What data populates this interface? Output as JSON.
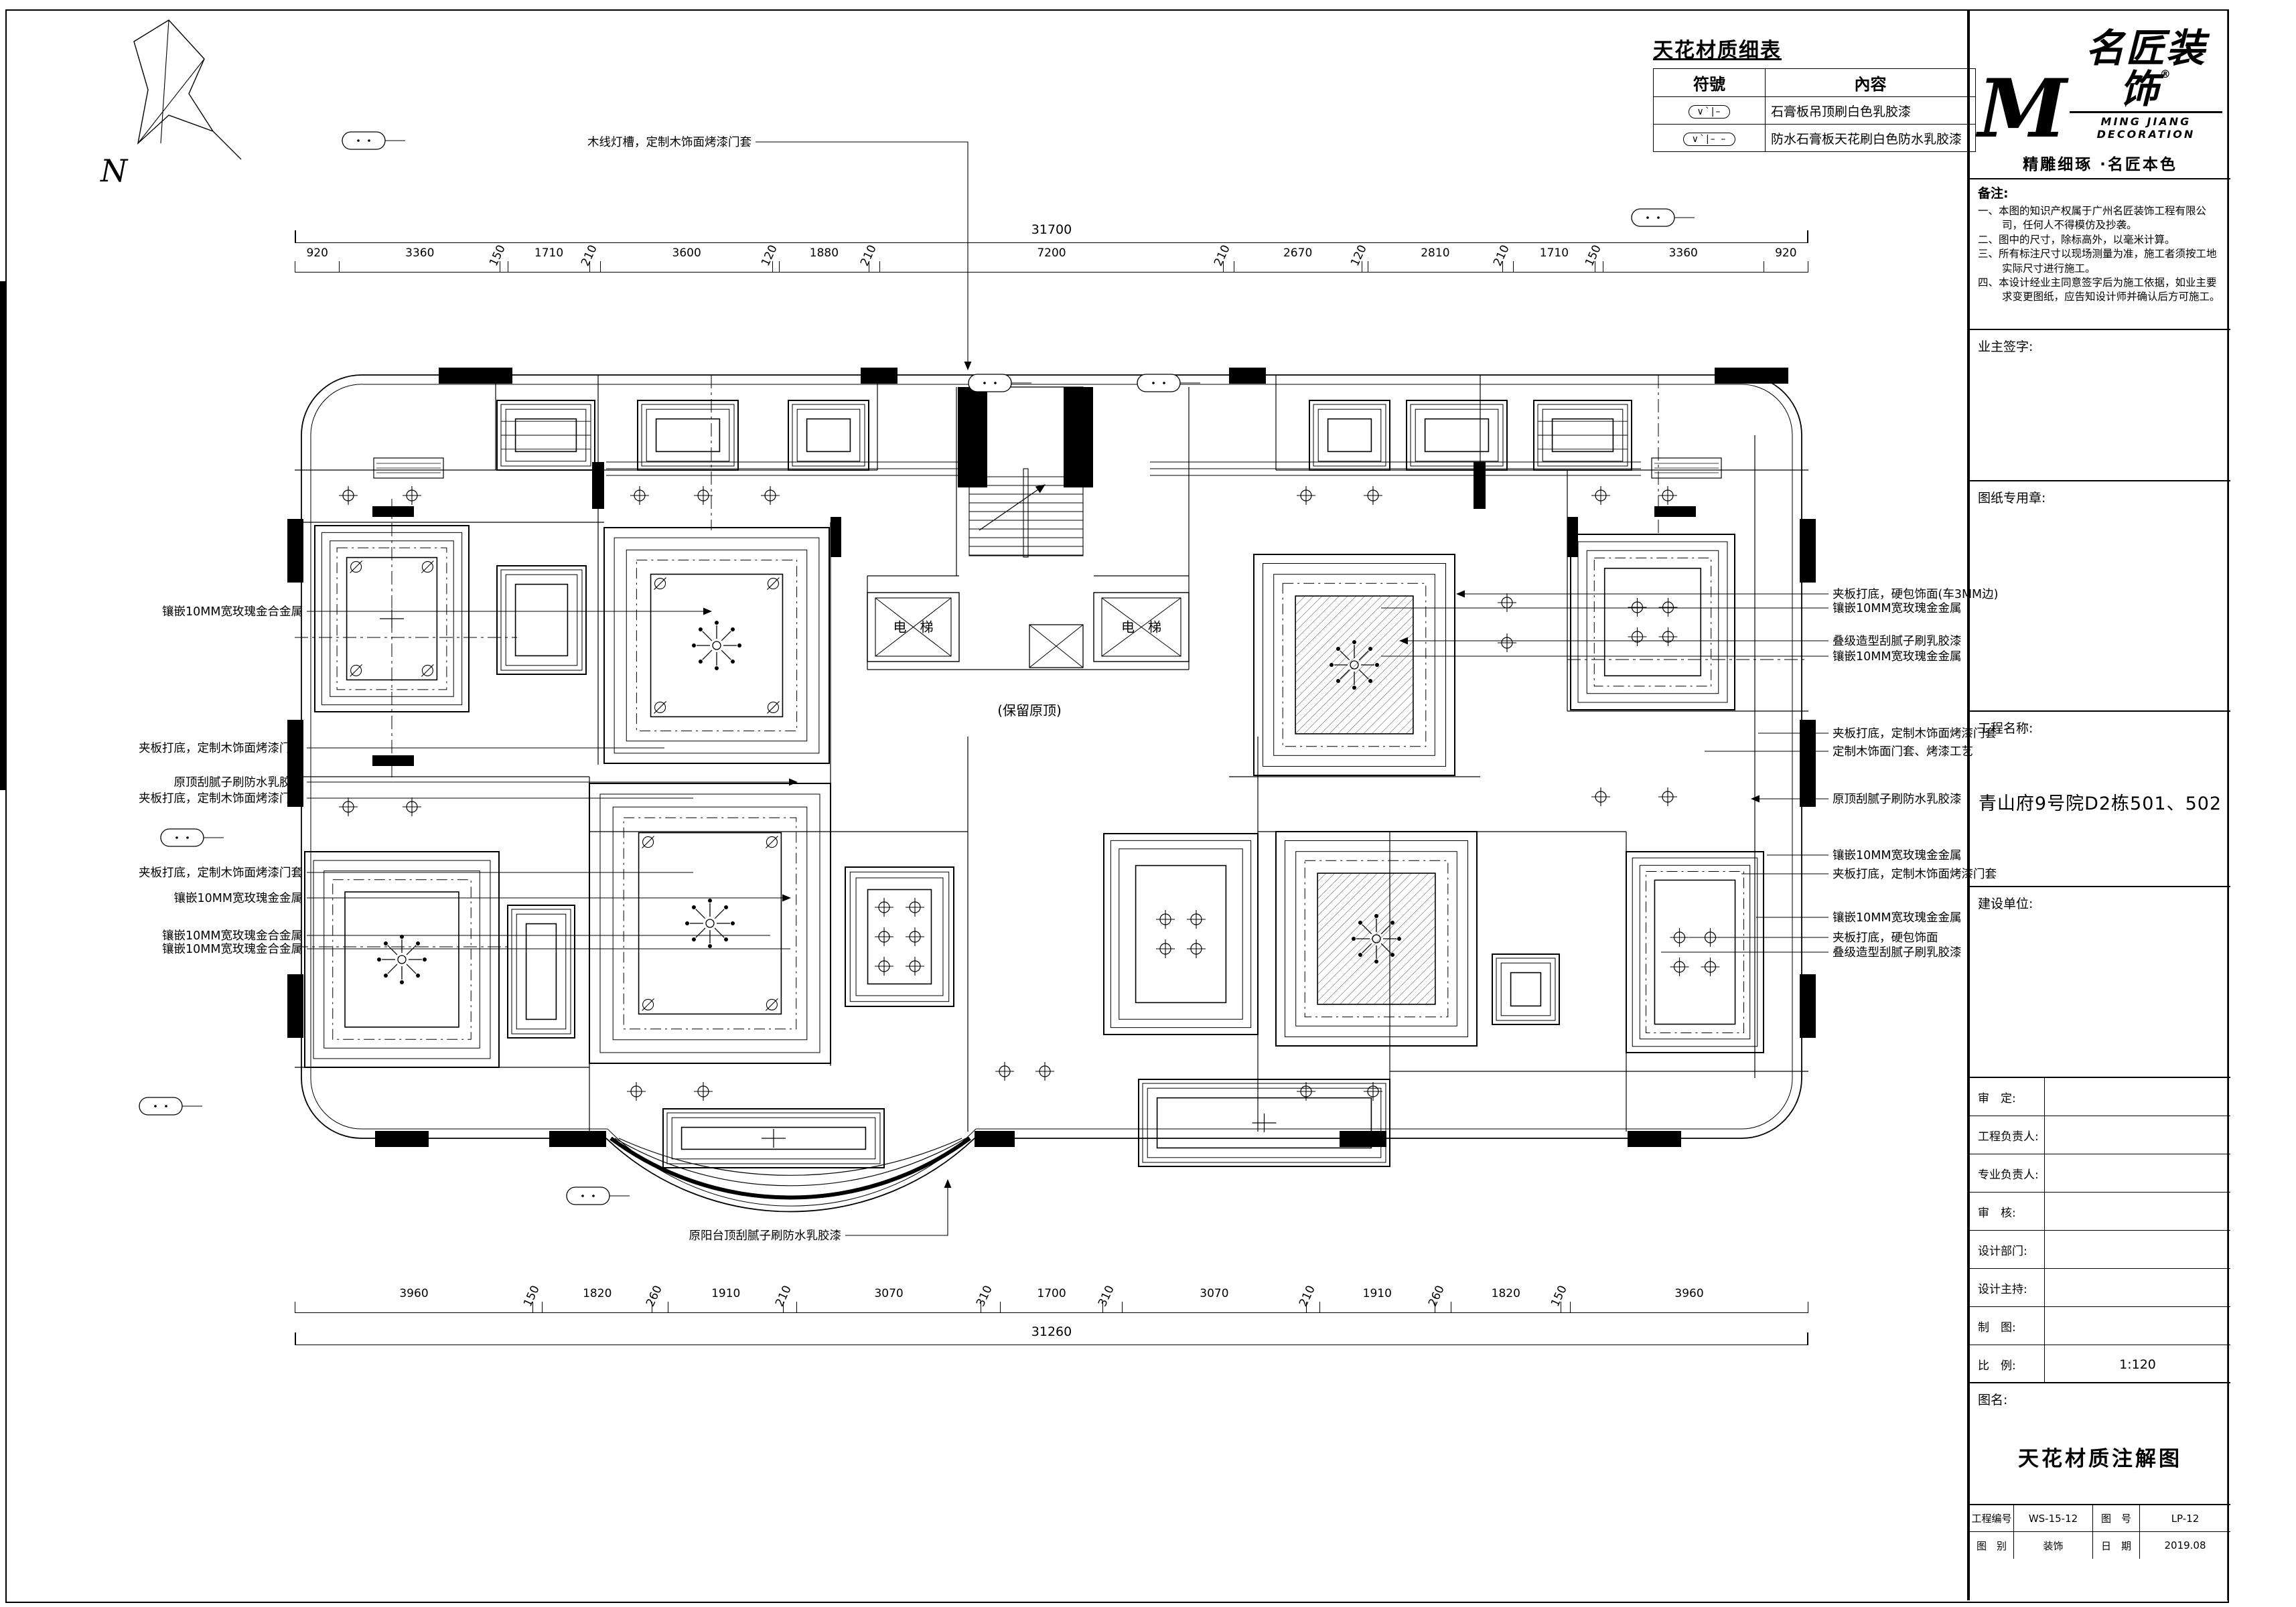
{
  "legend": {
    "title": "天花材质细表",
    "col_symbol": "符號",
    "col_content": "內容",
    "rows": [
      {
        "symbol": "∨ˋ|–",
        "content": "石膏板吊顶刷白色乳胶漆"
      },
      {
        "symbol": "∨ˋ|– –",
        "content": "防水石膏板天花刷白色防水乳胶漆"
      }
    ]
  },
  "plan": {
    "north": "N",
    "elevator": "电　梯",
    "keep_ceiling": "(保留原顶)"
  },
  "dimensions": {
    "top": {
      "total": "31700",
      "values": [
        920,
        3360,
        150,
        1710,
        210,
        3600,
        120,
        1880,
        210,
        7200,
        210,
        2670,
        120,
        2810,
        210,
        1710,
        150,
        3360,
        920
      ]
    },
    "bottom": {
      "total": "31260",
      "values": [
        3960,
        150,
        1820,
        260,
        1910,
        210,
        3070,
        310,
        1700,
        310,
        3070,
        210,
        1910,
        260,
        1820,
        150,
        3960
      ]
    }
  },
  "annotations": {
    "top": [
      "木线灯槽，定制木饰面烤漆门套"
    ],
    "bottom": [
      "原阳台顶刮腻子刷防水乳胶漆"
    ],
    "left": [
      "镶嵌10MM宽玫瑰金合金属",
      "夹板打底，定制木饰面烤漆门套",
      "原顶刮腻子刷防水乳胶漆",
      "夹板打底，定制木饰面烤漆门套",
      "夹板打底，定制木饰面烤漆门套",
      "镶嵌10MM宽玫瑰金金属",
      "镶嵌10MM宽玫瑰金合金属",
      "镶嵌10MM宽玫瑰金合金属"
    ],
    "right": [
      "夹板打底，硬包饰面(车3MM边)",
      "镶嵌10MM宽玫瑰金金属",
      "叠级造型刮腻子刷乳胶漆",
      "镶嵌10MM宽玫瑰金金属",
      "夹板打底，定制木饰面烤漆门套",
      "定制木饰面门套、烤漆工艺",
      "原顶刮腻子刷防水乳胶漆",
      "镶嵌10MM宽玫瑰金金属",
      "夹板打底，定制木饰面烤漆门套",
      "镶嵌10MM宽玫瑰金金属",
      "夹板打底，硬包饰面",
      "叠级造型刮腻子刷乳胶漆"
    ]
  },
  "titleblock": {
    "brand": {
      "m": "M",
      "name": "名匠装饰",
      "reg": "®",
      "en": "MING JIANG DECORATION",
      "slogan": "精雕细琢 ·名匠本色"
    },
    "notes_title": "备注:",
    "notes": [
      "一、本图的知识产权属于广州名匠装饰工程有限公司，任何人不得模仿及抄袭。",
      "二、图中的尺寸，除标高外，以毫米计算。",
      "三、所有标注尺寸以现场测量为准，施工者须按工地实际尺寸进行施工。",
      "四、本设计经业主同意签字后为施工依据，如业主要求变更图纸，应告知设计师并确认后方可施工。"
    ],
    "owner_sign": "业主签字:",
    "stamp": "图纸专用章:",
    "project_label": "工程名称:",
    "project_name": "青山府9号院D2栋501、502",
    "client_label": "建设单位:",
    "fields": [
      {
        "label": "审　定:",
        "value": ""
      },
      {
        "label": "工程负责人:",
        "value": ""
      },
      {
        "label": "专业负责人:",
        "value": ""
      },
      {
        "label": "审　核:",
        "value": ""
      },
      {
        "label": "设计部门:",
        "value": ""
      },
      {
        "label": "设计主持:",
        "value": ""
      },
      {
        "label": "制　图:",
        "value": ""
      },
      {
        "label": "比　例:",
        "value": "1:120"
      }
    ],
    "drawing_label": "图名:",
    "drawing_name": "天花材质注解图",
    "footer": {
      "pno_label": "工程编号",
      "pno": "WS-15-12",
      "fno_label": "图　号",
      "fno": "LP-12",
      "cat_label": "图　别",
      "cat": "装饰",
      "date_label": "日　期",
      "date": "2019.08"
    }
  }
}
